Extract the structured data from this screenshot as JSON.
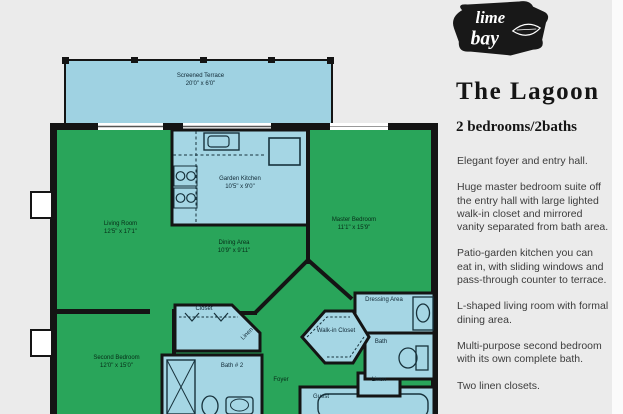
{
  "page": {
    "background": "#ebebeb",
    "right_margin_strip": "#fbfbfb"
  },
  "logo": {
    "word1": "lime",
    "word2": "bay"
  },
  "panel": {
    "title": "The Lagoon",
    "subtitle": "2 bedrooms/2baths",
    "paragraphs": [
      "Elegant foyer and entry hall.",
      "Huge master bedroom suite off the entry hall with large lighted walk-in closet and mirrored vanity separated from bath area.",
      "Patio-garden kitchen you can eat in, with sliding windows and pass-through counter to terrace.",
      "L-shaped living room with formal dining area.",
      "Multi-purpose second bedroom with its own complete bath.",
      "Two linen closets."
    ]
  },
  "floorplan": {
    "colors": {
      "room_green": "#29a55a",
      "room_blue": "#a5d6e4",
      "terrace_blue": "#9fd2e2",
      "wall": "#141414"
    },
    "rooms": {
      "terrace": {
        "name": "Screened Terrace",
        "dims": "20'0\" x 6'0\""
      },
      "living": {
        "name": "Living Room",
        "dims": "12'5\" x 17'1\""
      },
      "kitchen": {
        "name": "Garden Kitchen",
        "dims": "10'5\" x 9'0\""
      },
      "dining": {
        "name": "Dining Area",
        "dims": "10'9\" x 9'11\""
      },
      "master": {
        "name": "Master Bedroom",
        "dims": "11'1\" x 15'9\""
      },
      "second": {
        "name": "Second Bedroom",
        "dims": "12'0\" x 15'0\""
      },
      "closet": {
        "name": "Closet"
      },
      "linen1": {
        "name": "Linen"
      },
      "bath2": {
        "name": "Bath # 2"
      },
      "foyer": {
        "name": "Foyer"
      },
      "walkin": {
        "name": "Walk-in Closet"
      },
      "dressing": {
        "name": "Dressing Area"
      },
      "bath": {
        "name": "Bath"
      },
      "linen2": {
        "name": "Linen"
      },
      "guest": {
        "name": "Guest"
      }
    }
  }
}
